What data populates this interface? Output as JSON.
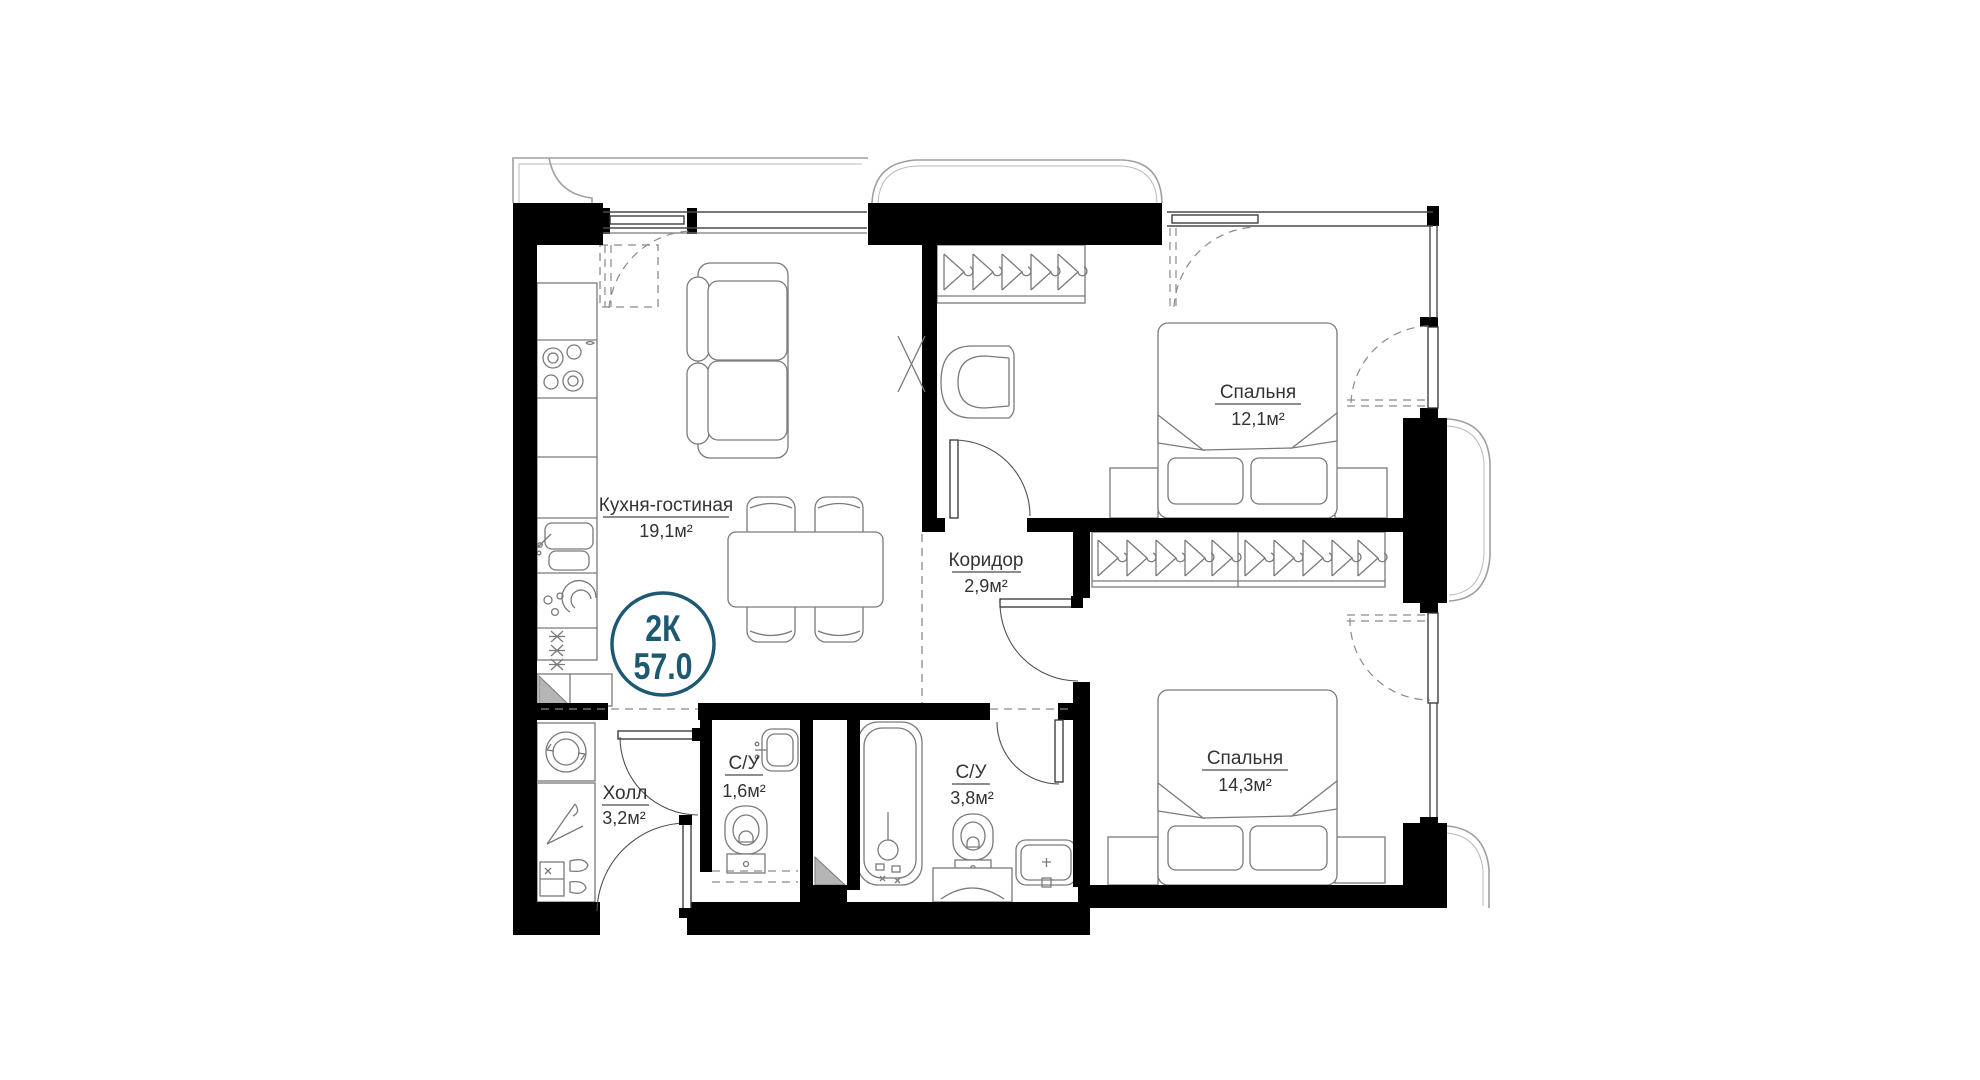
{
  "plan": {
    "badge": {
      "rooms_type": "2К",
      "total_area": "57.0"
    },
    "rooms": [
      {
        "key": "kitchen_living",
        "name": "Кухня-гостиная",
        "area": "19,1м²"
      },
      {
        "key": "corridor",
        "name": "Коридор",
        "area": "2,9м²"
      },
      {
        "key": "bedroom_1",
        "name": "Спальня",
        "area": "12,1м²"
      },
      {
        "key": "bedroom_2",
        "name": "Спальня",
        "area": "14,3м²"
      },
      {
        "key": "bathroom_small",
        "name": "С/У",
        "area": "1,6м²"
      },
      {
        "key": "bathroom_big",
        "name": "С/У",
        "area": "3,8м²"
      },
      {
        "key": "hall",
        "name": "Холл",
        "area": "3,2м²"
      }
    ],
    "colors": {
      "badge_teal": "#1d5a72",
      "wall_black": "#000000",
      "furniture_gray": "#7a7a7a",
      "terrace_gray": "#9f9f9f",
      "label_dark": "#333333",
      "shaft_gray": "#b5b5b5"
    }
  }
}
